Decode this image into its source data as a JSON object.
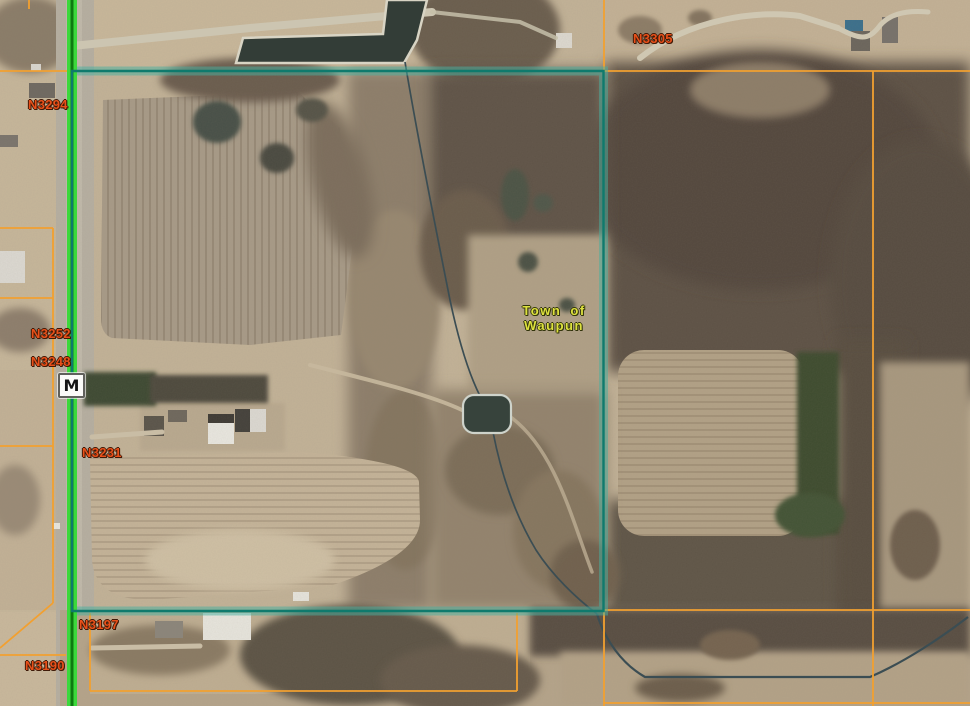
{
  "map": {
    "address_labels": [
      {
        "id": "n3294",
        "text": "N3294"
      },
      {
        "id": "n3252",
        "text": "N3252"
      },
      {
        "id": "n3248",
        "text": "N3248"
      },
      {
        "id": "n3231",
        "text": "N3231"
      },
      {
        "id": "n3197",
        "text": "N3197"
      },
      {
        "id": "n3190",
        "text": "N3190"
      },
      {
        "id": "n3305",
        "text": "N3305"
      }
    ],
    "town_label": {
      "line1": "Town of",
      "line2": "Waupun"
    },
    "highway_shield": {
      "label": "M"
    },
    "feature_colors": {
      "selected_parcel_outline": "#0f7a6d",
      "selected_parcel_halo": "#46afa0",
      "parcel_line_orange": "#f2a030",
      "highlighted_road_green": "#3cd83c",
      "highlighted_road_core": "#0e7a11",
      "address_label_text": "#e8501a",
      "town_label_text": "#dde13e",
      "water": "#37433c"
    }
  }
}
